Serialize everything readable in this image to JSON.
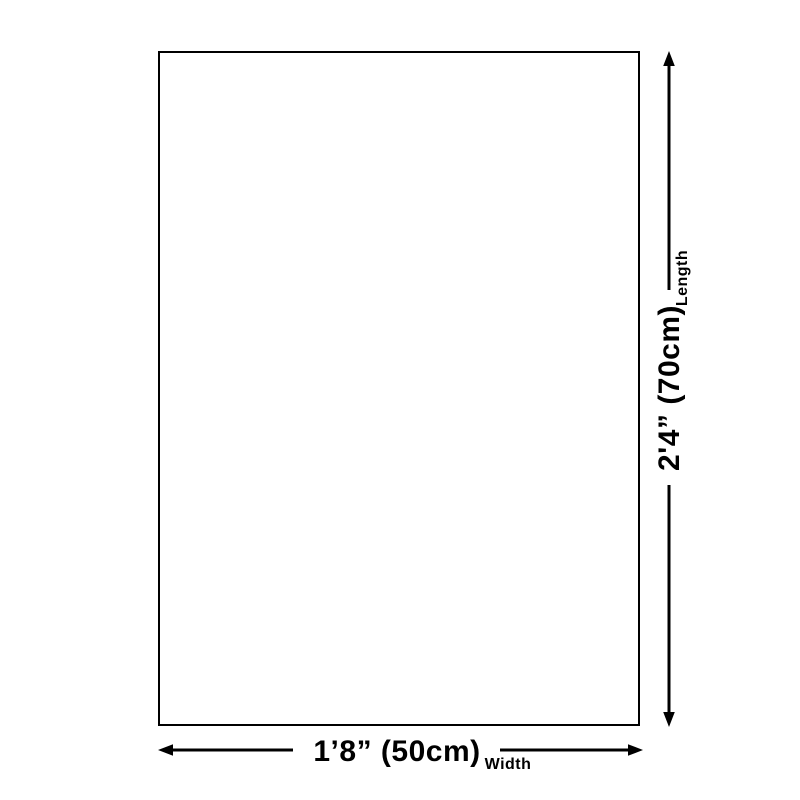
{
  "dimensions": {
    "length": {
      "value": "2'4” (70cm)",
      "label": "Length"
    },
    "width": {
      "value": "1’8” (50cm)",
      "label": "Width"
    }
  },
  "colors": {
    "ink": "#000000",
    "background": "#ffffff"
  }
}
